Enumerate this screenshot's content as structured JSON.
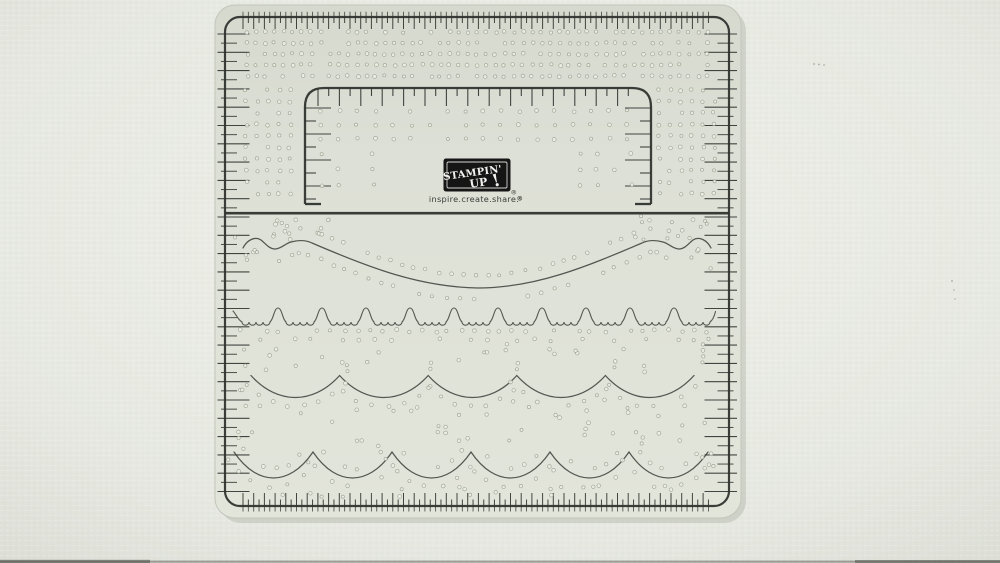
{
  "scene": {
    "description": "Photograph of a clear Stampin' Up! paper-piercing / ruler template laying on a textured white-grey craft mat",
    "object": "paper-piercing-template-photo"
  },
  "logo": {
    "brand_line1": "STAMPIN'",
    "brand_line2": "UP",
    "exclamation": "!",
    "registered": "®",
    "tagline": "inspire.create.share.",
    "tagline_registered": "®"
  },
  "colors": {
    "background_center": "#eef0e9",
    "background_edge": "#dfe1d9",
    "plastic_top": "#d7dacf",
    "plastic_mid": "#dde0d6",
    "plastic_bottom": "#e3e6db",
    "plastic_edge": "#c3c6ba",
    "plastic_shadow": "#b2b6a9",
    "line": "#30342f",
    "hole_fill": "#edf0e7",
    "hole_stroke": "#9aa090",
    "logo_box": "#151515",
    "logo_inner_border": "#e8e8e4",
    "logo_text": "#f2f2ee",
    "tagline_color": "#3b3e37",
    "photo_edge_dark": "#4b4c45"
  },
  "features": {
    "outer_frame": "ruler-border",
    "inner_frame": "inner-ruler-window",
    "divider": "horizontal-divider-line",
    "row1": "swag-piercing-guide",
    "row2": "lace-scallop-piercing-guide",
    "row3": "large-scallop-piercing-guide",
    "row4": "small-scallop-piercing-guide",
    "holes": "pierce-hole-grid"
  }
}
